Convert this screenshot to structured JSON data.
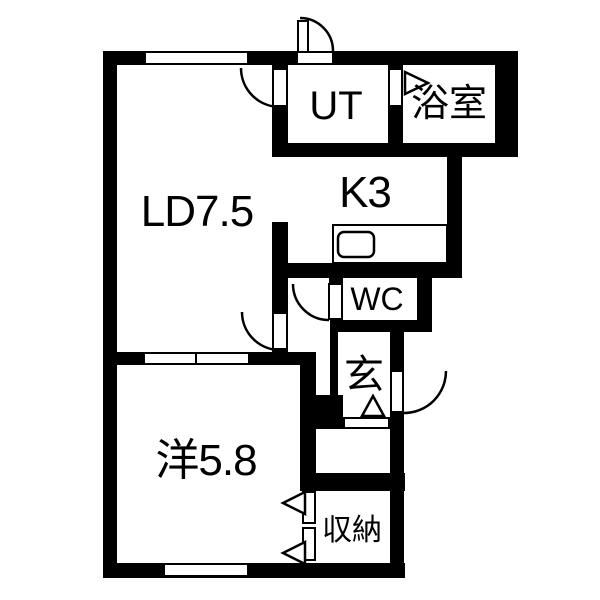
{
  "plan": {
    "colors": {
      "wall": "#000000",
      "background": "#ffffff",
      "line": "#000000"
    },
    "rooms": [
      {
        "key": "living_dining",
        "label": "LD7.5"
      },
      {
        "key": "kitchen",
        "label": "K3"
      },
      {
        "key": "utility",
        "label": "UT"
      },
      {
        "key": "bathroom",
        "label": "浴室"
      },
      {
        "key": "toilet",
        "label": "WC"
      },
      {
        "key": "entrance",
        "label": "玄"
      },
      {
        "key": "western_room",
        "label": "洋5.8"
      },
      {
        "key": "storage",
        "label": "収納"
      }
    ]
  }
}
